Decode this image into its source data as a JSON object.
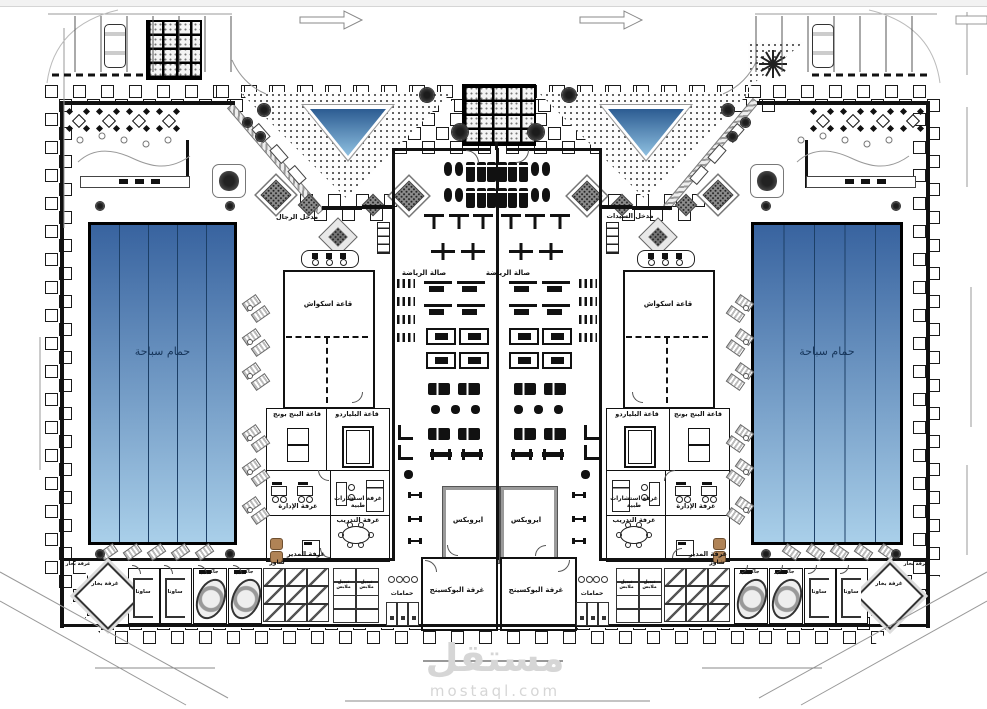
{
  "watermark": {
    "title": "مستقل",
    "domain": "mostaql.com"
  },
  "entrances": {
    "men": "مدخل الرجال",
    "women": "مدخل السيدات"
  },
  "rooms": {
    "pool": "حمام سباحة",
    "gym": "صالة الرياضة",
    "squash": "قاعة اسكواش",
    "pingpong": "قاعة البنج بونج",
    "billiards": "قاعة البلياردو",
    "admin": "غرفة الإدارة",
    "medical": "غرفة استشارات طبية",
    "manager": "غرفة المدير",
    "training": "غرفة التدريب",
    "aerobics": "ايروبكس",
    "boxing": "غرفة البوكسينج",
    "bathrooms": "حمامات",
    "steam": "غرفة بخار",
    "sauna": "ساونا",
    "jacuzzi": "جاكوزي",
    "shower": "شاور",
    "lockers": "تبديل ملابس"
  },
  "colors": {
    "pool_top": "#38639f",
    "pool_bottom": "#a9cfe9",
    "lane_line": "#1c3f66",
    "fountain_top": "#2c5c92",
    "fountain_bottom": "#8fc0e0",
    "hatch_gray": "#9a9a9a",
    "armchair_brown": "#b08356",
    "watermark_gray": "#d6d6d6",
    "pool_label": "#16355a"
  }
}
